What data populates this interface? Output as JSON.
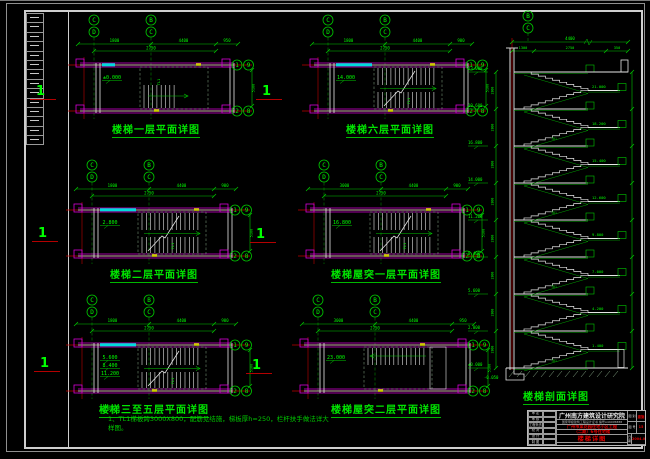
{
  "palette": {
    "green": "#00c800",
    "bright_green": "#00ff00",
    "dim_green": "#00a000",
    "magenta": "#d800d8",
    "cyan": "#00dcdc",
    "red": "#c00000",
    "white": "#e6e6e6",
    "yellow": "#cccc00",
    "gray": "#9a9a9a"
  },
  "plans": [
    {
      "title": "楼梯一层平面详图",
      "type": "ground",
      "cyan": "short",
      "grid_top": [
        [
          "C",
          "D"
        ],
        [
          "B",
          "C"
        ]
      ],
      "grid_right": [
        [
          "1",
          "9"
        ],
        [
          "2",
          "8"
        ]
      ],
      "dims_top": [
        "1800",
        "4400",
        "950"
      ],
      "dims_top2": [
        "2750"
      ],
      "dim_right": "5100",
      "elevations": [
        "±0.000"
      ],
      "flight_label": "TL1",
      "section_mark": "1"
    },
    {
      "title": "楼梯六层平面详图",
      "type": "full",
      "cyan": "bar",
      "grid_top": [
        [
          "C",
          "D"
        ],
        [
          "B",
          "C"
        ]
      ],
      "grid_right": [
        [
          "1",
          "9"
        ],
        [
          "2",
          "8"
        ]
      ],
      "dims_top": [
        "1800",
        "4400",
        "900"
      ],
      "dims_top2": [
        "2750"
      ],
      "dim_right": "5100",
      "elevations": [
        "14.000"
      ],
      "flight_label": "TL1",
      "section_mark": "1"
    },
    {
      "title": "楼梯二层平面详图",
      "type": "full",
      "cyan": "bar",
      "grid_top": [
        [
          "C",
          "D"
        ],
        [
          "B",
          "C"
        ]
      ],
      "grid_right": [
        [
          "1",
          "9"
        ],
        [
          "2",
          "8"
        ]
      ],
      "dims_top": [
        "1800",
        "4400",
        "900"
      ],
      "dims_top2": [
        "2750"
      ],
      "dim_right": "5100",
      "elevations": [
        "2.800"
      ],
      "flight_label": "TL1",
      "section_mark": "1"
    },
    {
      "title": "楼梯屋突一层平面详图",
      "type": "full",
      "cyan": "none",
      "grid_top": [
        [
          "C",
          "D"
        ],
        [
          "B",
          "C"
        ]
      ],
      "grid_right": [
        [
          "1",
          "9"
        ],
        [
          "2",
          "8"
        ]
      ],
      "dims_top": [
        "3000",
        "4400",
        "900"
      ],
      "dims_top2": [
        "2750"
      ],
      "dim_right": "5100",
      "elevations": [
        "16.800"
      ],
      "flight_label": "TL1",
      "section_mark": "1"
    },
    {
      "title": "楼梯三至五层平面详图",
      "type": "full",
      "cyan": "bar",
      "grid_top": [
        [
          "C",
          "D"
        ],
        [
          "B",
          "C"
        ]
      ],
      "grid_right": [
        [
          "1",
          "9"
        ],
        [
          "2",
          "8"
        ]
      ],
      "dims_top": [
        "1800",
        "4400",
        "900"
      ],
      "dims_top2": [
        "2750"
      ],
      "dim_right": "5100",
      "elevations": [
        "5.600",
        "8.400",
        "11.200"
      ],
      "flight_label": "TL1",
      "section_mark": "1"
    },
    {
      "title": "楼梯屋突二层平面详图",
      "type": "upper",
      "cyan": "none",
      "grid_top": [
        [
          "C",
          "D"
        ],
        [
          "B",
          "C"
        ]
      ],
      "grid_right": [
        [
          "1",
          "9"
        ],
        [
          "2",
          "8"
        ]
      ],
      "dims_top": [
        "3000",
        "4400",
        "950"
      ],
      "dims_top2": [
        "2750"
      ],
      "dim_right": "5100",
      "elevations": [
        "23.000"
      ],
      "flight_label": "TL1",
      "section_mark": "1"
    }
  ],
  "notes": {
    "heading": "说明：",
    "lines": [
      "1、TL1梯板跨3000X800，配筋见结施，梯板厚h=250，栏杆扶手做法详大样图。"
    ]
  },
  "section": {
    "title": "楼梯剖面详图",
    "grid_top": [
      "B",
      "C"
    ],
    "dim_top": "4400",
    "dims_top2": [
      "1300",
      "2750",
      "350"
    ],
    "storey_dim": "2800",
    "floor_elevations": [
      "±0.000",
      "2.800",
      "5.600",
      "8.400",
      "11.200",
      "14.000",
      "16.800",
      "19.600",
      "23.000"
    ],
    "landing_elevations": [
      "1.400",
      "4.200",
      "7.000",
      "9.800",
      "12.600",
      "15.400",
      "18.200",
      "21.000"
    ],
    "base_elevation": "-0.050",
    "flight_label": "TB1"
  },
  "titleblock": {
    "company": "广州南方建筑设计研究院",
    "certificate": "国家甲级建筑工程设计证书 编号A44005888",
    "project_line1": "广州市某花园住宅小区工程",
    "project_line2": "（二期）6号住宅楼",
    "drawing_title": "楼梯详图",
    "rows": [
      {
        "label": "审 定"
      },
      {
        "label": "审 核"
      },
      {
        "label": "工程负责"
      },
      {
        "label": "校 对"
      },
      {
        "label": "设 计"
      },
      {
        "label": "制 图"
      }
    ],
    "fields": [
      {
        "label": "图 别",
        "value": "建施"
      },
      {
        "label": "图 号",
        "value": "15"
      },
      {
        "label": "日 期",
        "value": "2004.07"
      }
    ]
  }
}
